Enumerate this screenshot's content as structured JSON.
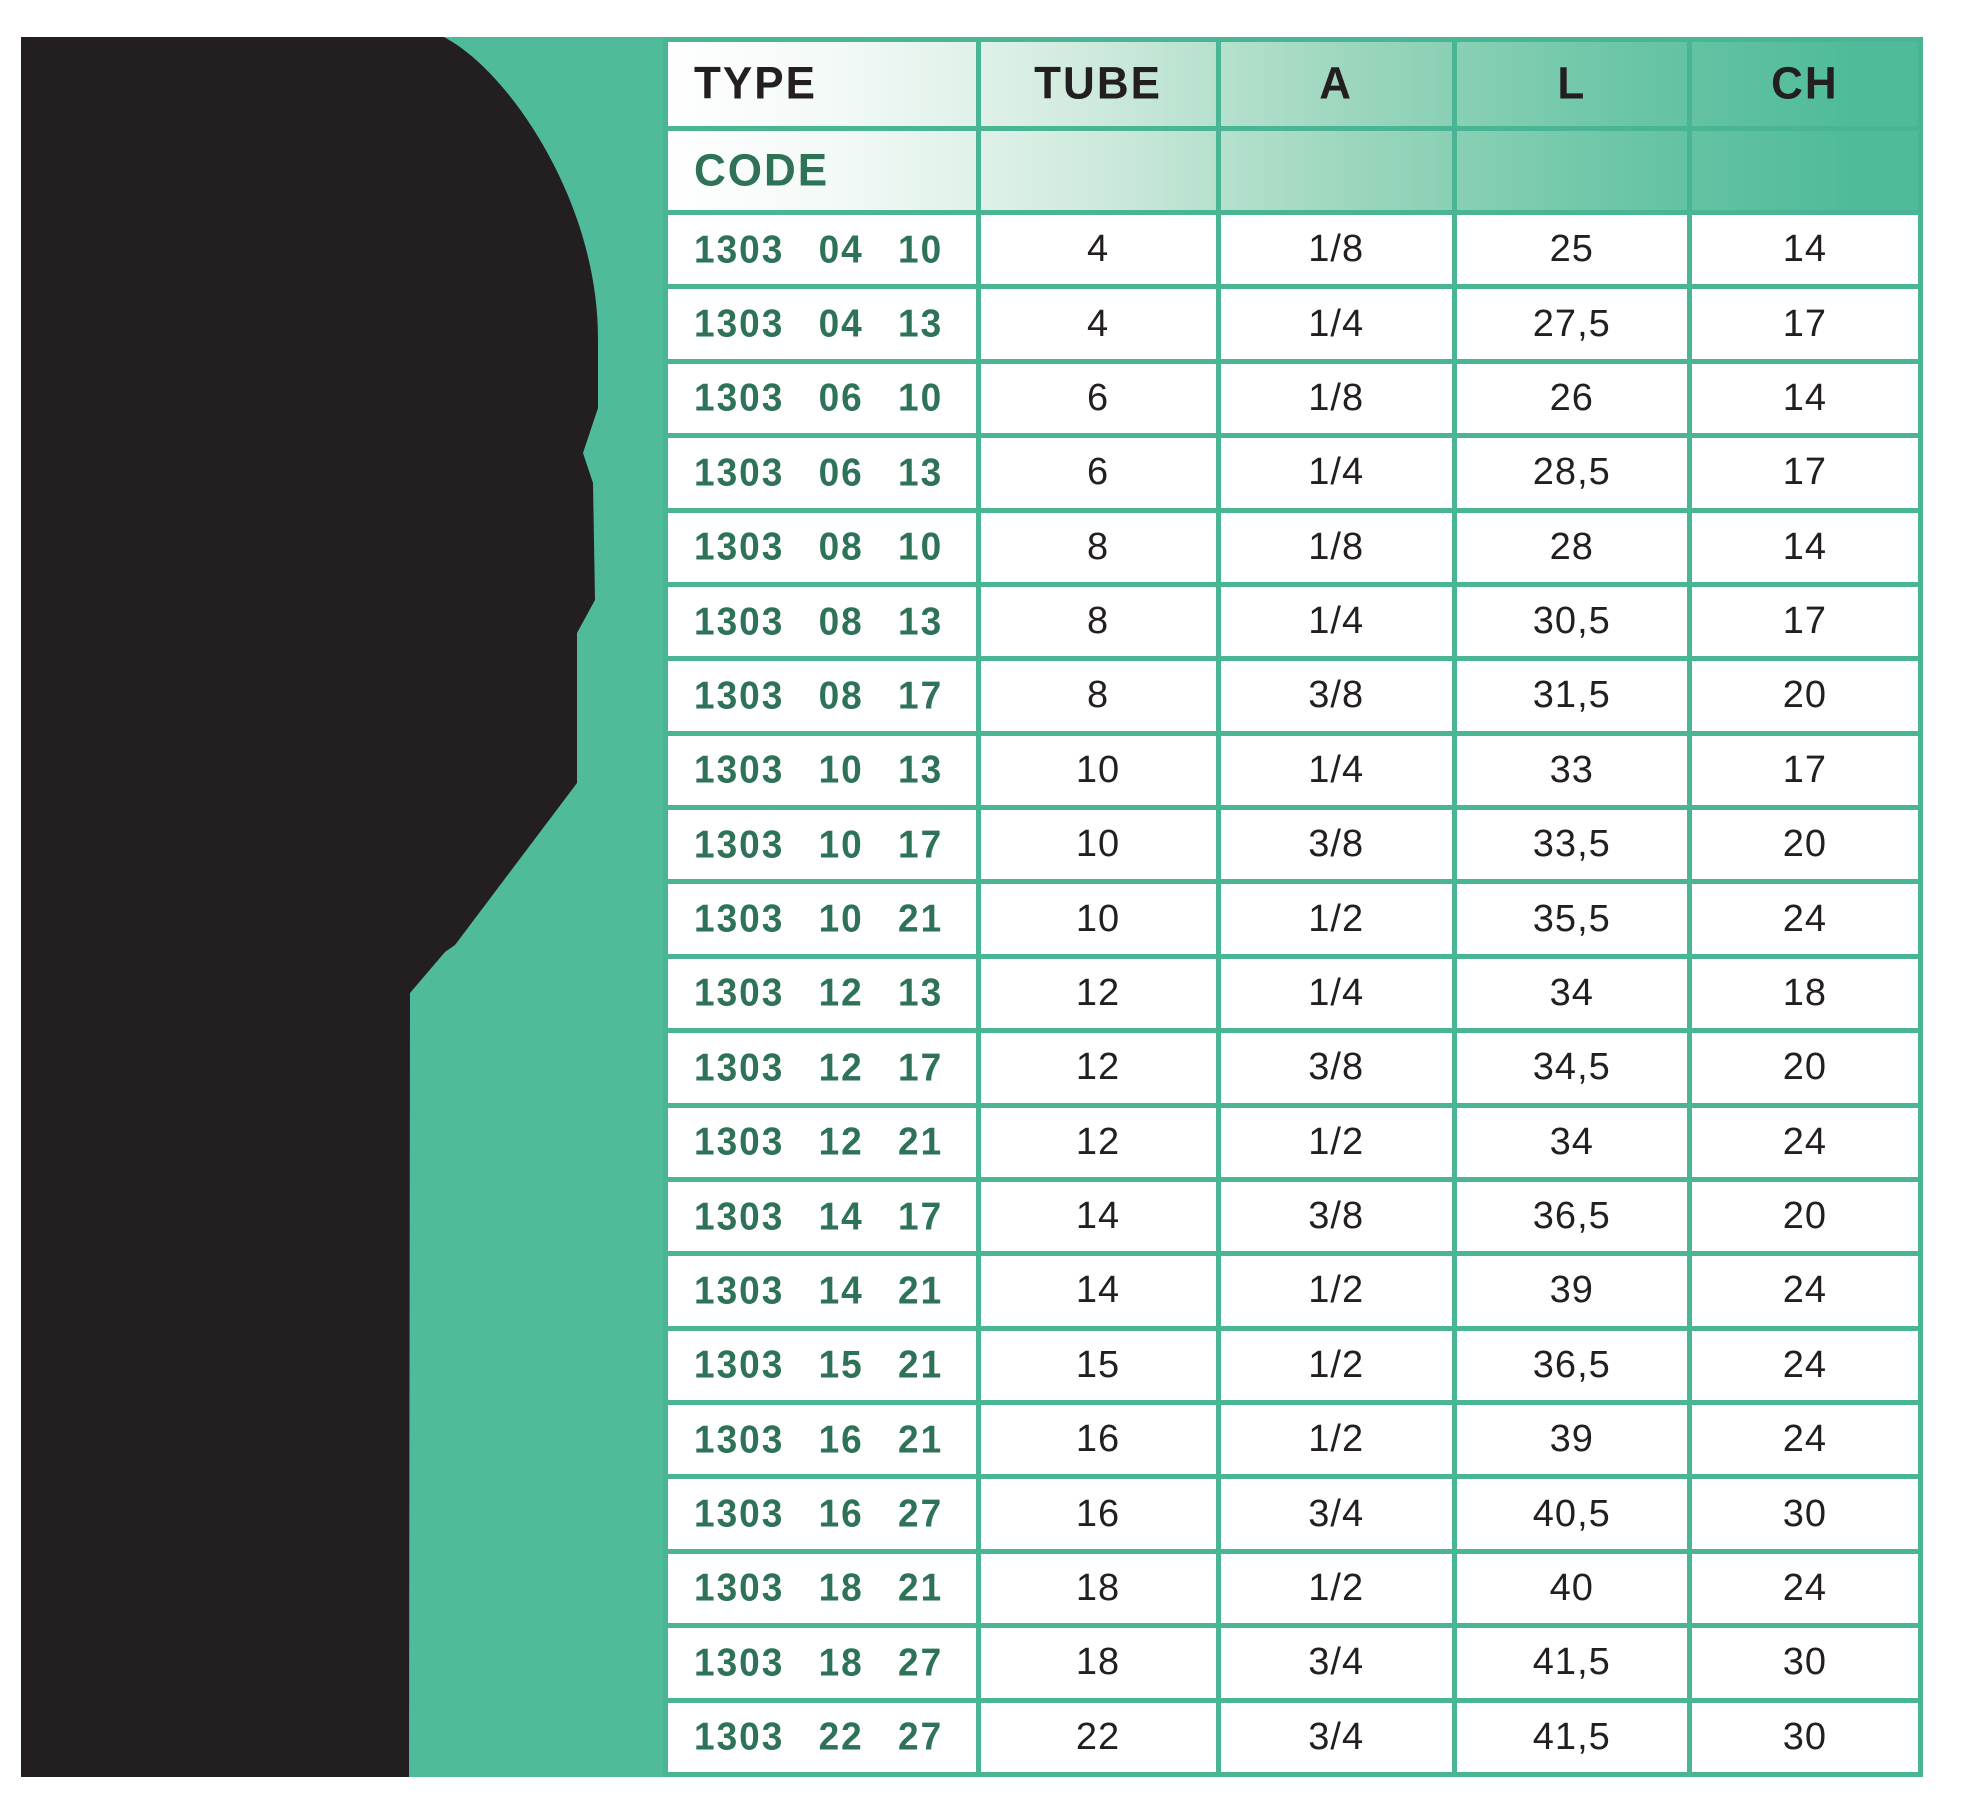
{
  "page": {
    "background": "#FFFFFF"
  },
  "board": {
    "background_color": "#4FBB9A"
  },
  "silhouette": {
    "description": "black product silhouette (push-in fitting)",
    "color": "#231F20"
  },
  "colors": {
    "teal_background": "#4FBB9A",
    "grid_line": "#4AB595",
    "header_text": "#231F20",
    "code_text_green": "#2E7257",
    "value_text": "#231F20",
    "header_gradient_start": "#FFFFFF",
    "header_gradient_end": "#4FBB9A"
  },
  "table": {
    "headers": {
      "type": "TYPE",
      "tube": "TUBE",
      "a": "A",
      "l": "L",
      "ch": "CH"
    },
    "code_label": "CODE",
    "rows": [
      {
        "code": "1303 04 10",
        "tube": "4",
        "a": "1/8",
        "l": "25",
        "ch": "14"
      },
      {
        "code": "1303 04 13",
        "tube": "4",
        "a": "1/4",
        "l": "27,5",
        "ch": "17"
      },
      {
        "code": "1303 06 10",
        "tube": "6",
        "a": "1/8",
        "l": "26",
        "ch": "14"
      },
      {
        "code": "1303 06 13",
        "tube": "6",
        "a": "1/4",
        "l": "28,5",
        "ch": "17"
      },
      {
        "code": "1303 08 10",
        "tube": "8",
        "a": "1/8",
        "l": "28",
        "ch": "14"
      },
      {
        "code": "1303 08 13",
        "tube": "8",
        "a": "1/4",
        "l": "30,5",
        "ch": "17"
      },
      {
        "code": "1303 08 17",
        "tube": "8",
        "a": "3/8",
        "l": "31,5",
        "ch": "20"
      },
      {
        "code": "1303 10 13",
        "tube": "10",
        "a": "1/4",
        "l": "33",
        "ch": "17"
      },
      {
        "code": "1303 10 17",
        "tube": "10",
        "a": "3/8",
        "l": "33,5",
        "ch": "20"
      },
      {
        "code": "1303 10 21",
        "tube": "10",
        "a": "1/2",
        "l": "35,5",
        "ch": "24"
      },
      {
        "code": "1303 12 13",
        "tube": "12",
        "a": "1/4",
        "l": "34",
        "ch": "18"
      },
      {
        "code": "1303 12 17",
        "tube": "12",
        "a": "3/8",
        "l": "34,5",
        "ch": "20"
      },
      {
        "code": "1303 12 21",
        "tube": "12",
        "a": "1/2",
        "l": "34",
        "ch": "24"
      },
      {
        "code": "1303 14 17",
        "tube": "14",
        "a": "3/8",
        "l": "36,5",
        "ch": "20"
      },
      {
        "code": "1303 14 21",
        "tube": "14",
        "a": "1/2",
        "l": "39",
        "ch": "24"
      },
      {
        "code": "1303 15 21",
        "tube": "15",
        "a": "1/2",
        "l": "36,5",
        "ch": "24"
      },
      {
        "code": "1303 16 21",
        "tube": "16",
        "a": "1/2",
        "l": "39",
        "ch": "24"
      },
      {
        "code": "1303 16 27",
        "tube": "16",
        "a": "3/4",
        "l": "40,5",
        "ch": "30"
      },
      {
        "code": "1303 18 21",
        "tube": "18",
        "a": "1/2",
        "l": "40",
        "ch": "24"
      },
      {
        "code": "1303 18 27",
        "tube": "18",
        "a": "3/4",
        "l": "41,5",
        "ch": "30"
      },
      {
        "code": "1303 22 27",
        "tube": "22",
        "a": "3/4",
        "l": "41,5",
        "ch": "30"
      }
    ]
  }
}
